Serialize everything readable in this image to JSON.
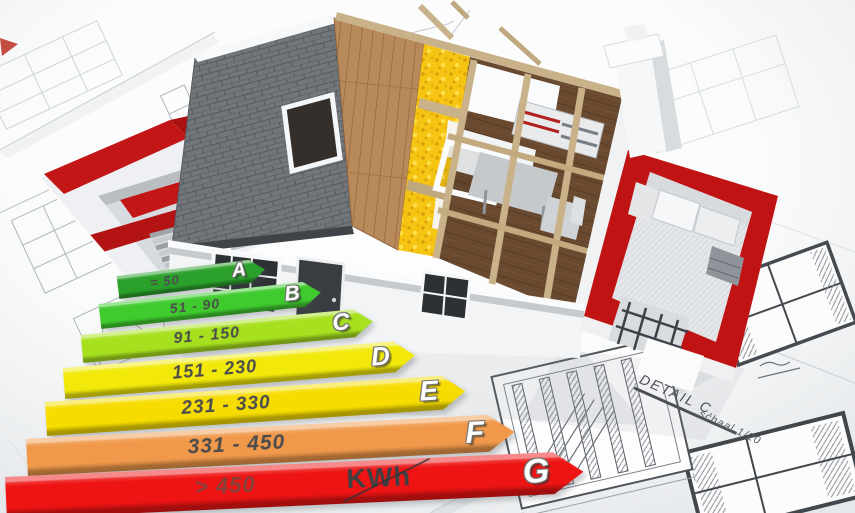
{
  "energy_scale": {
    "unit_label": "KWh",
    "classes": [
      {
        "grade": "A",
        "range": "= 50",
        "color": "#2ba02b"
      },
      {
        "grade": "B",
        "range": "51 - 90",
        "color": "#3fca2e"
      },
      {
        "grade": "C",
        "range": "91 - 150",
        "color": "#a7e01e"
      },
      {
        "grade": "D",
        "range": "151 - 230",
        "color": "#f2e90a"
      },
      {
        "grade": "E",
        "range": "231 - 330",
        "color": "#f6dc00"
      },
      {
        "grade": "F",
        "range": "331 - 450",
        "color": "#f0994a"
      },
      {
        "grade": "G",
        "range": "> 450",
        "color": "#ee1414"
      }
    ]
  },
  "blueprint_annotations": {
    "detail_label": "DETAIL C.",
    "scale_label": "schaal 1/20"
  },
  "palette": {
    "wall_red": "#c31616",
    "roof_tile_gray": "#71767b",
    "roof_wood_brown": "#b8895a",
    "insulation_yellow": "#f6c514",
    "attic_floor_brown": "#6f4e33",
    "timber_beige": "#c9b289"
  },
  "chart_data": {
    "type": "bar",
    "title": "Energy efficiency rating scale",
    "categories": [
      "A",
      "B",
      "C",
      "D",
      "E",
      "F",
      "G"
    ],
    "labels": [
      "= 50",
      "51 - 90",
      "91 - 150",
      "151 - 230",
      "231 - 330",
      "331 - 450",
      "> 450"
    ],
    "values": [
      50,
      90,
      150,
      230,
      330,
      450,
      451
    ],
    "unit": "KWh",
    "colors": [
      "#2ba02b",
      "#3fca2e",
      "#a7e01e",
      "#f2e90a",
      "#f6dc00",
      "#f0994a",
      "#ee1414"
    ],
    "legend_position": "none",
    "orientation": "horizontal"
  }
}
